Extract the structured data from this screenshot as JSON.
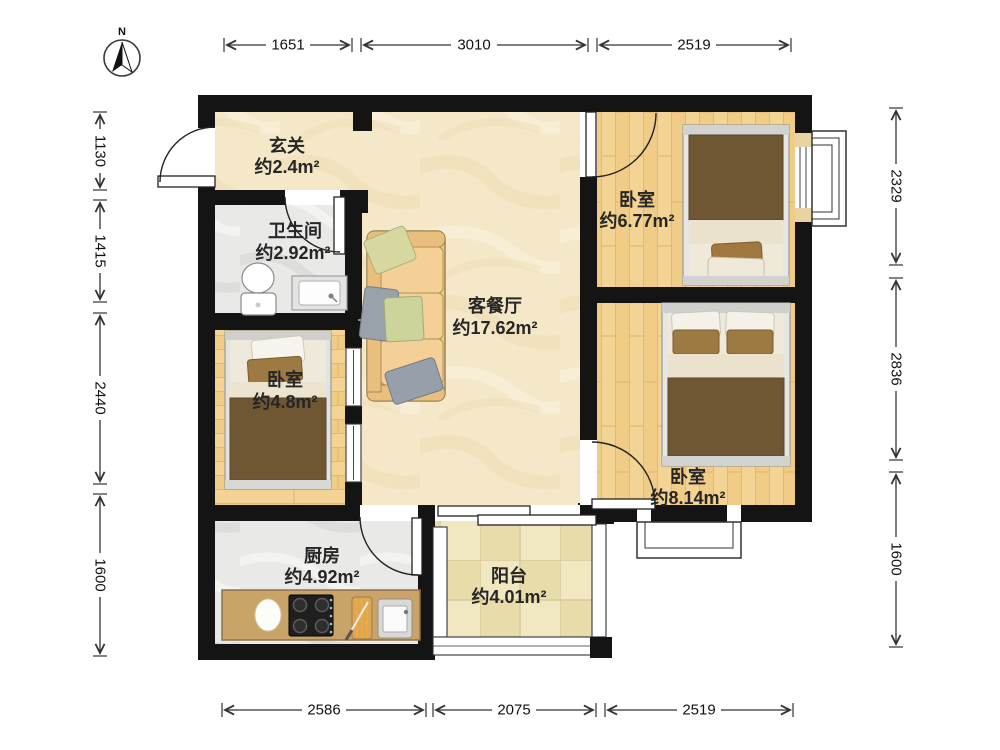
{
  "compass": {
    "north_label": "N"
  },
  "dimensions": {
    "top": [
      {
        "label": "1651"
      },
      {
        "label": "3010"
      },
      {
        "label": "2519"
      }
    ],
    "bottom": [
      {
        "label": "2586"
      },
      {
        "label": "2075"
      },
      {
        "label": "2519"
      }
    ],
    "left": [
      {
        "label": "1130"
      },
      {
        "label": "1415"
      },
      {
        "label": "2440"
      },
      {
        "label": "1600"
      }
    ],
    "right": [
      {
        "label": "2329"
      },
      {
        "label": "2836"
      },
      {
        "label": "1600"
      }
    ]
  },
  "rooms": {
    "entry": {
      "name": "玄关",
      "area": "约2.4m²"
    },
    "bathroom": {
      "name": "卫生间",
      "area": "约2.92m²"
    },
    "living": {
      "name": "客餐厅",
      "area": "约17.62m²"
    },
    "bedroom_top_right": {
      "name": "卧室",
      "area": "约6.77m²"
    },
    "bedroom_left": {
      "name": "卧室",
      "area": "约4.8m²"
    },
    "bedroom_bottom_right": {
      "name": "卧室",
      "area": "约8.14m²"
    },
    "kitchen": {
      "name": "厨房",
      "area": "约4.92m²"
    },
    "balcony": {
      "name": "阳台",
      "area": "约4.01m²"
    }
  },
  "palette": {
    "wall": "#141414",
    "wood_floor": "#f4d494",
    "marble_beige": "#f4e8c8",
    "marble_gray": "#e9e9e7",
    "balcony_tile": "#f1e7c0",
    "counter_tan": "#c9a368",
    "blanket_brown": "#6f5733",
    "sofa_tan": "#f1ca8e",
    "dimension_line": "#333333"
  }
}
